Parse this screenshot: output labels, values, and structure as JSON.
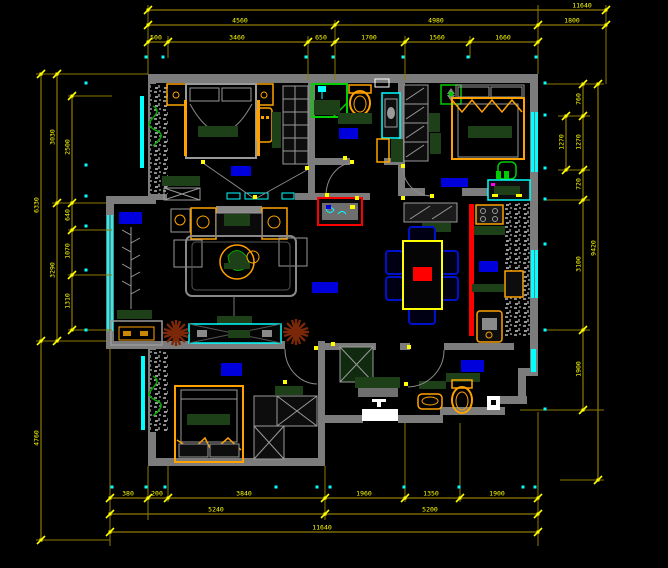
{
  "app": {
    "name": "cad-floor-plan",
    "background": "#000000"
  },
  "palette": {
    "wall_gray": "#7c7c7c",
    "furn_gray": "#9a9a9a",
    "dim_line": "#8f7a00",
    "dim_text": "#ffff00",
    "tick_yellow": "#ffff00",
    "window_cyan": "#00ffff",
    "accent_orange": "#ffa200",
    "dark_green": "#1d4018",
    "bright_green": "#00cc00",
    "label_blue": "#0000dd",
    "accent_red": "#ff0000",
    "plant_brown": "#7a2808",
    "white": "#ffffff"
  },
  "dimensions": {
    "chains": [
      {
        "id": "top-overall",
        "dir": "h",
        "pos": 10,
        "from": 148,
        "to": 606,
        "ticks": [
          148,
          606
        ],
        "labels": [
          {
            "at": 582,
            "text": "11640"
          }
        ]
      },
      {
        "id": "top-mid",
        "dir": "h",
        "pos": 25,
        "from": 148,
        "to": 606,
        "ticks": [
          148,
          335,
          538,
          606
        ],
        "labels": [
          {
            "at": 240,
            "text": "4560"
          },
          {
            "at": 436,
            "text": "4980"
          },
          {
            "at": 572,
            "text": "1800"
          }
        ]
      },
      {
        "id": "top-inner",
        "dir": "h",
        "pos": 42,
        "from": 148,
        "to": 538,
        "ticks": [
          148,
          168,
          308,
          335,
          405,
          470,
          538
        ],
        "labels": [
          {
            "at": 156,
            "text": "500"
          },
          {
            "at": 237,
            "text": "3460"
          },
          {
            "at": 321,
            "text": "650"
          },
          {
            "at": 369,
            "text": "1700"
          },
          {
            "at": 437,
            "text": "1560"
          },
          {
            "at": 503,
            "text": "1660"
          }
        ]
      },
      {
        "id": "bottom-inner",
        "dir": "h",
        "pos": 498,
        "from": 110,
        "to": 538,
        "ticks": [
          110,
          148,
          168,
          325,
          405,
          460,
          538
        ],
        "labels": [
          {
            "at": 128,
            "text": "380"
          },
          {
            "at": 157,
            "text": "200"
          },
          {
            "at": 244,
            "text": "3840"
          },
          {
            "at": 364,
            "text": "1960"
          },
          {
            "at": 431,
            "text": "1350"
          },
          {
            "at": 497,
            "text": "1900"
          }
        ]
      },
      {
        "id": "bottom-mid",
        "dir": "h",
        "pos": 514,
        "from": 110,
        "to": 538,
        "ticks": [
          110,
          325,
          538
        ],
        "labels": [
          {
            "at": 216,
            "text": "5240"
          },
          {
            "at": 430,
            "text": "5200"
          }
        ]
      },
      {
        "id": "bottom-overall",
        "dir": "h",
        "pos": 532,
        "from": 110,
        "to": 538,
        "ticks": [
          110,
          538
        ],
        "labels": [
          {
            "at": 322,
            "text": "11640"
          }
        ]
      },
      {
        "id": "left-overall",
        "dir": "v",
        "pos": 41,
        "from": 74,
        "to": 540,
        "ticks": [
          74,
          341,
          540
        ],
        "labels": [
          {
            "at": 205,
            "text": "6330"
          },
          {
            "at": 438,
            "text": "4760"
          }
        ]
      },
      {
        "id": "left-mid",
        "dir": "v",
        "pos": 57,
        "from": 74,
        "to": 341,
        "ticks": [
          74,
          203,
          341
        ],
        "labels": [
          {
            "at": 137,
            "text": "3030"
          },
          {
            "at": 270,
            "text": "3290"
          }
        ]
      },
      {
        "id": "left-inner",
        "dir": "v",
        "pos": 72,
        "from": 96,
        "to": 330,
        "ticks": [
          96,
          203,
          230,
          275,
          330
        ],
        "labels": [
          {
            "at": 147,
            "text": "2500"
          },
          {
            "at": 215,
            "text": "640"
          },
          {
            "at": 251,
            "text": "1070"
          },
          {
            "at": 301,
            "text": "1310"
          }
        ]
      },
      {
        "id": "right-inner",
        "dir": "v",
        "pos": 583,
        "from": 84,
        "to": 410,
        "ticks": [
          84,
          116,
          170,
          200,
          330,
          410
        ],
        "labels": [
          {
            "at": 99,
            "text": "760"
          },
          {
            "at": 142,
            "text": "1270"
          },
          {
            "at": 184,
            "text": "720"
          },
          {
            "at": 264,
            "text": "3100"
          },
          {
            "at": 369,
            "text": "1900"
          }
        ]
      },
      {
        "id": "right-window",
        "dir": "v",
        "pos": 566,
        "from": 116,
        "to": 170,
        "ticks": [
          116,
          170
        ],
        "labels": [
          {
            "at": 142,
            "text": "1270"
          }
        ]
      },
      {
        "id": "right-overall",
        "dir": "v",
        "pos": 598,
        "from": 84,
        "to": 480,
        "ticks": [
          84,
          480
        ],
        "labels": [
          {
            "at": 248,
            "text": "9420"
          }
        ]
      }
    ],
    "ext_lines": [
      [
        148,
        5,
        148,
        74
      ],
      [
        335,
        20,
        335,
        80
      ],
      [
        538,
        5,
        538,
        74
      ],
      [
        606,
        5,
        606,
        84
      ],
      [
        168,
        36,
        168,
        58
      ],
      [
        308,
        36,
        308,
        80
      ],
      [
        405,
        36,
        405,
        80
      ],
      [
        470,
        36,
        470,
        58
      ],
      [
        110,
        348,
        110,
        546
      ],
      [
        148,
        466,
        148,
        520
      ],
      [
        168,
        466,
        168,
        502
      ],
      [
        325,
        466,
        325,
        520
      ],
      [
        405,
        423,
        405,
        502
      ],
      [
        460,
        423,
        460,
        502
      ],
      [
        538,
        412,
        538,
        546
      ],
      [
        36,
        74,
        148,
        74
      ],
      [
        52,
        203,
        106,
        203
      ],
      [
        36,
        341,
        106,
        341
      ],
      [
        36,
        540,
        110,
        540
      ],
      [
        68,
        96,
        112,
        96
      ],
      [
        68,
        230,
        112,
        230
      ],
      [
        68,
        275,
        112,
        275
      ],
      [
        68,
        330,
        112,
        330
      ],
      [
        545,
        84,
        604,
        84
      ],
      [
        558,
        116,
        590,
        116
      ],
      [
        558,
        170,
        590,
        170
      ],
      [
        545,
        200,
        590,
        200
      ],
      [
        545,
        330,
        590,
        330
      ],
      [
        520,
        410,
        604,
        410
      ],
      [
        560,
        480,
        604,
        480
      ]
    ],
    "dots": [
      [
        146,
        57
      ],
      [
        163,
        57
      ],
      [
        306,
        57
      ],
      [
        333,
        57
      ],
      [
        403,
        57
      ],
      [
        468,
        57
      ],
      [
        536,
        57
      ],
      [
        112,
        487
      ],
      [
        146,
        487
      ],
      [
        165,
        487
      ],
      [
        276,
        487
      ],
      [
        317,
        487
      ],
      [
        330,
        487
      ],
      [
        404,
        487
      ],
      [
        459,
        487
      ],
      [
        523,
        487
      ],
      [
        535,
        487
      ],
      [
        86,
        83
      ],
      [
        86,
        165
      ],
      [
        86,
        196
      ],
      [
        86,
        226
      ],
      [
        86,
        270
      ],
      [
        86,
        330
      ],
      [
        545,
        83
      ],
      [
        545,
        115
      ],
      [
        545,
        168
      ],
      [
        545,
        199
      ],
      [
        545,
        244
      ],
      [
        545,
        330
      ],
      [
        545,
        409
      ]
    ]
  },
  "room_labels": [
    {
      "name": "master-bedroom-label",
      "x": 231,
      "y": 166,
      "w": 20,
      "h": 10
    },
    {
      "name": "bathroom-1-label",
      "x": 339,
      "y": 128,
      "w": 19,
      "h": 11
    },
    {
      "name": "bedroom-2-label",
      "x": 441,
      "y": 178,
      "w": 27,
      "h": 9
    },
    {
      "name": "living-room-label",
      "x": 119,
      "y": 212,
      "w": 23,
      "h": 12
    },
    {
      "name": "hallway-label",
      "x": 312,
      "y": 282,
      "w": 26,
      "h": 11
    },
    {
      "name": "kitchen-label",
      "x": 479,
      "y": 261,
      "w": 19,
      "h": 11
    },
    {
      "name": "bedroom-3-label",
      "x": 221,
      "y": 363,
      "w": 21,
      "h": 13
    },
    {
      "name": "bathroom-2-label",
      "x": 461,
      "y": 360,
      "w": 23,
      "h": 12
    }
  ]
}
